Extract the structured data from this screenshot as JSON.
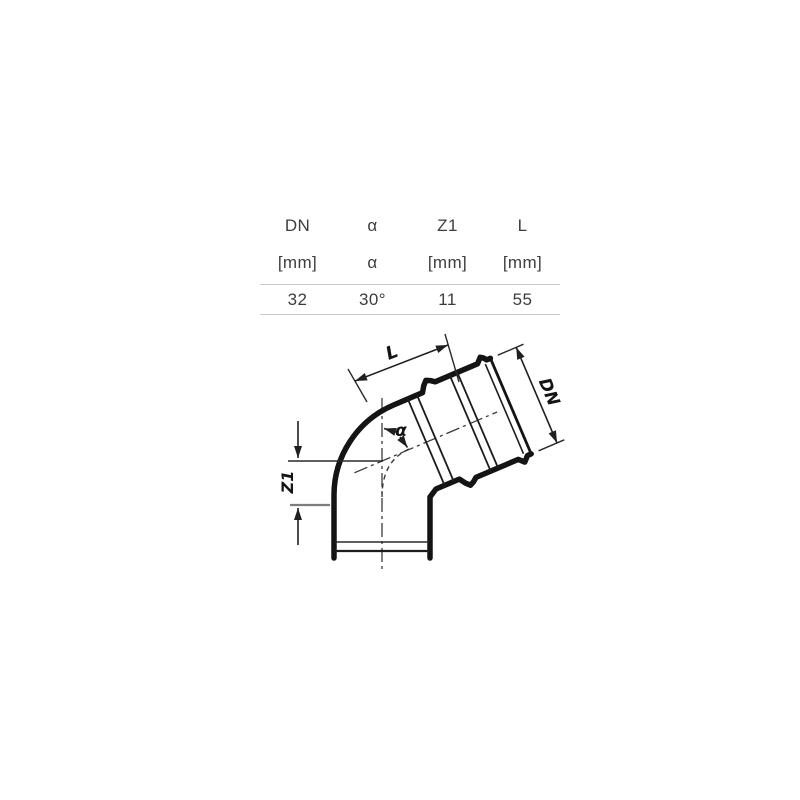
{
  "spec_table": {
    "columns": [
      {
        "header": "DN",
        "unit": "[mm]",
        "value": "32"
      },
      {
        "header": "α",
        "unit": "α",
        "value": "30°"
      },
      {
        "header": "Z1",
        "unit": "[mm]",
        "value": "11"
      },
      {
        "header": "L",
        "unit": "[mm]",
        "value": "55"
      }
    ]
  },
  "drawing": {
    "type": "technical-drawing-pipe-elbow-socket-bend",
    "labels": {
      "length": "L",
      "diameter": "DN",
      "offset": "Z1",
      "angle": "α"
    },
    "colors": {
      "outline": "#141414",
      "dimension": "#1f1f1f",
      "centerline": "#3a3a3a",
      "gray_extension": "#7d7d7d",
      "table_rule": "#c9c9c9",
      "table_text": "#3d3d3d",
      "background": "#ffffff"
    }
  }
}
